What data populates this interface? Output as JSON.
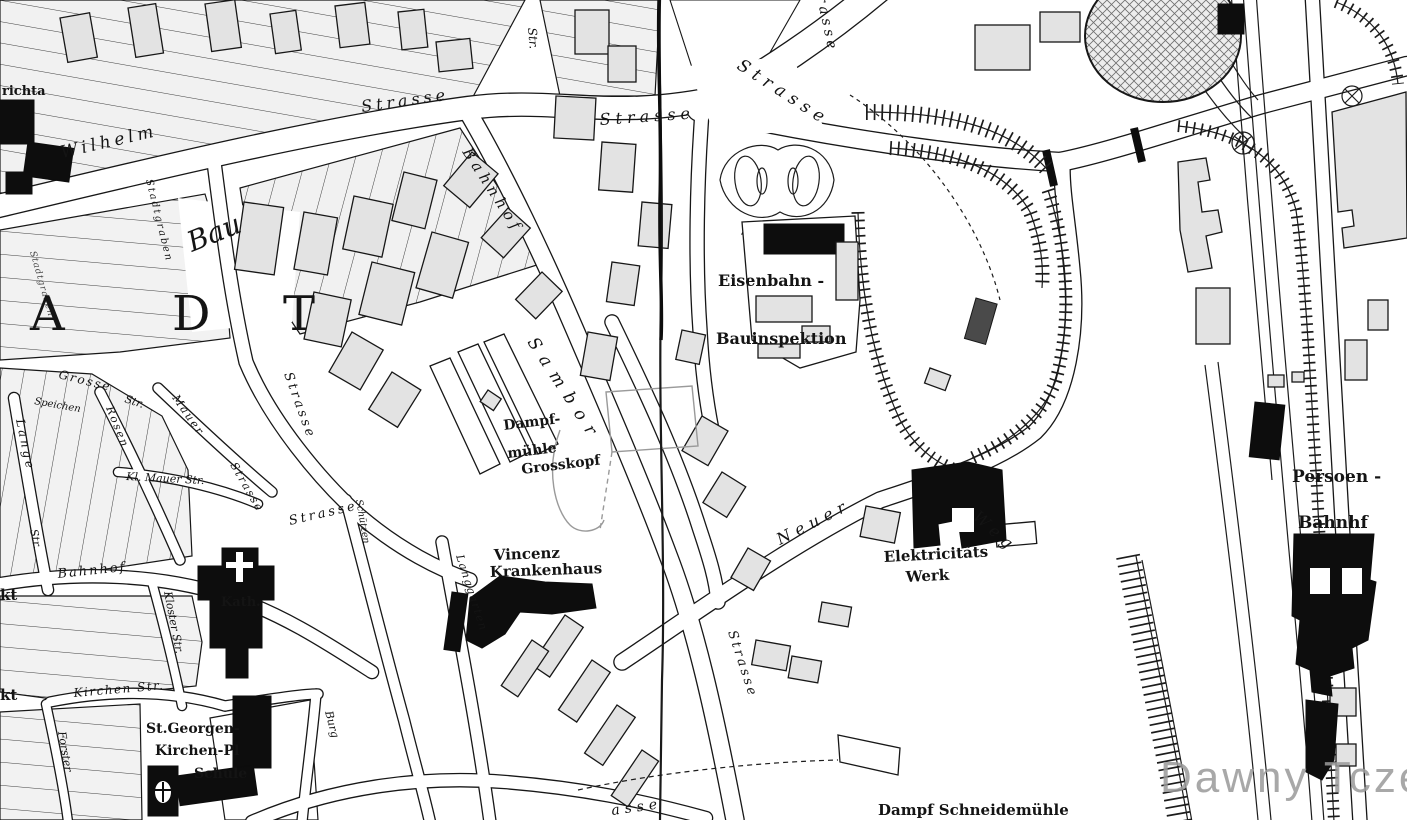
{
  "watermark": {
    "text": "Dawny Tczew",
    "color": "#9a9a9a"
  },
  "colors": {
    "background": "#ffffff",
    "ink": "#141414",
    "building_fill": "#e3e3e3",
    "solid_building": "#0d0d0d",
    "pencil_gray": "#9a9a9a"
  },
  "labels": {
    "richta": "richta",
    "wilhelm": "Wilhelm",
    "strasse_wilhelm": "Strasse",
    "str_top": "Str.",
    "strasse_mid": "Strasse",
    "strasse_diag": "Strasse",
    "strasse_vert_top": "Strasse",
    "bahnhof_diag": "Bahnhof",
    "stadtgraben": "Stadtgraben",
    "stadtgraben2": "Stadtgraben",
    "bau_pencil": "Bau",
    "letter_a": "A",
    "letter_d": "D",
    "letter_t": "T",
    "grosse": "Grosse",
    "str_grosse": "Str.",
    "speichen": "Speichen",
    "lange": "Lange",
    "str_lange": "Str.",
    "rosen": "Rosen",
    "mauer": "Mauer",
    "strasse_mauer": "Strasse",
    "kl_mauer": "Kl. Mauer Str.",
    "strasse_main": "Strasse",
    "strasse_low": "Strasse",
    "schuetzen": "Schützen",
    "langgarten": "Langgarten",
    "sambor": "Sambor",
    "dampf": "Dampf-",
    "muehle": "mühle",
    "grosskopf": "Grosskopf",
    "vincenz": "Vincenz",
    "krankenhaus": "Krankenhaus",
    "eisenbahn": "Eisenbahn -",
    "bauinspektion": "Bauinspektion",
    "weg": "Weg",
    "neuer": "Neuer",
    "elektricitaets": "Elektricitäts",
    "werk": "Werk",
    "persoen": "Persoen -",
    "bahnhf": "Bahnhf",
    "kath": "Kath.",
    "bahnhof_street": "Bahnhof",
    "kloster": "Kloster Str.",
    "kirchen_str": "Kirchen Str.",
    "st_georgen": "St.Georgen-",
    "kirchen_pl": "Kirchen-Pl",
    "schule": "Schule",
    "forster": "Forster",
    "markt1": "kt",
    "markt2": "kt",
    "burg": "Burg",
    "strasse_bottom": "Strasse",
    "asse_bottom": "asse",
    "schneidemuehle": "Dampf Schneidemühle"
  }
}
